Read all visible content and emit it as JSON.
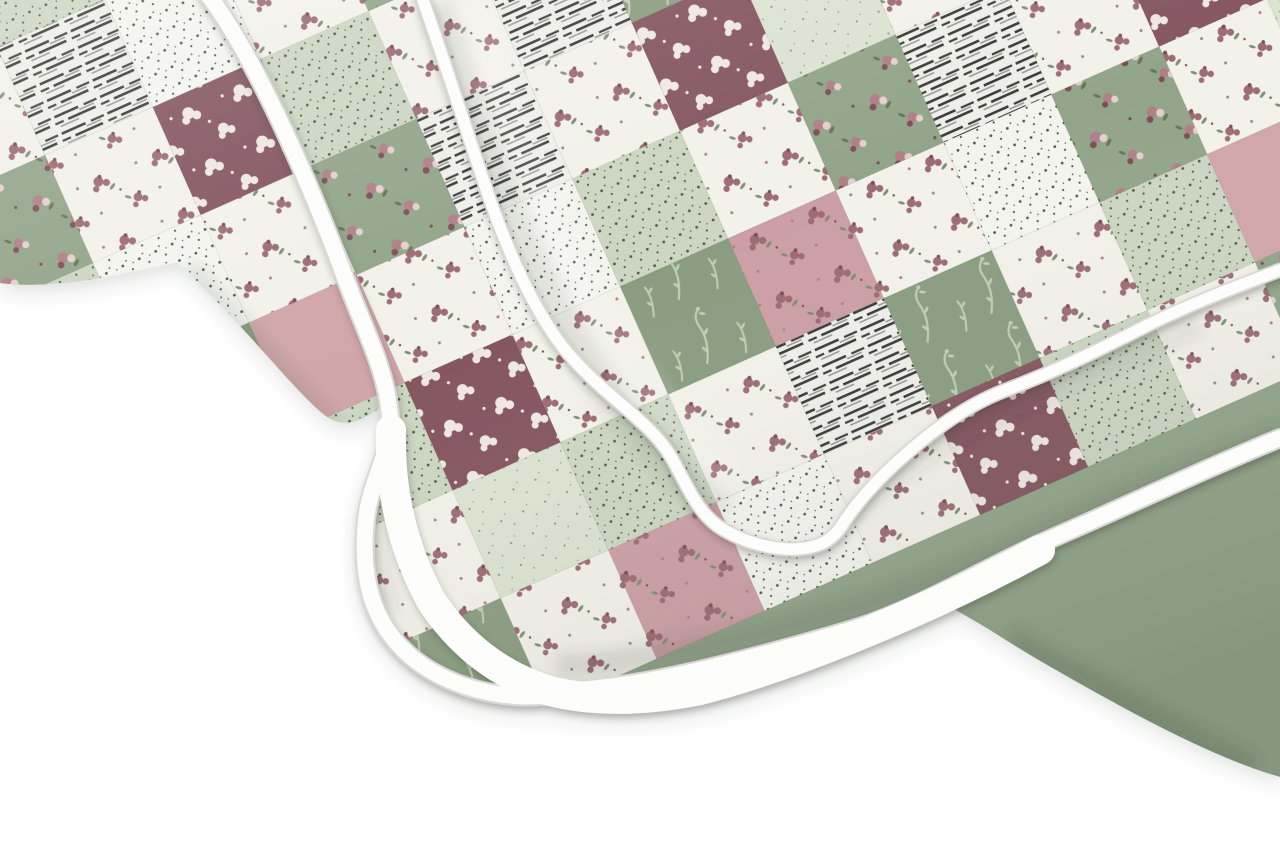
{
  "meta": {
    "description": "Product photo of a folded quilted patchwork bedspread with rounded white piped binding edges, draped diagonally across the top of the frame on a plain white background. The patchwork mixes sage green damask squares, light green and white dotted prints, white patches with dusty-rose flower clusters, wine-red floral squares, solid dusty pink and cream strips, and white patches with thin gray stripes."
  },
  "quilt": {
    "patch_size": 118,
    "patch_rotation_deg": -24,
    "palette": {
      "bg": "#ffffff",
      "sage": "#92a58a",
      "sage2": "#8a9d81",
      "ltgreen": "#ccd6c2",
      "mint": "#dce3d1",
      "cream": "#e8e8d1",
      "pink": "#d1a6a9",
      "pink2": "#cb9fa5",
      "white": "#f2f1ea",
      "white2": "#f4f4ef",
      "white3": "#efefe9",
      "wine": "#855660",
      "dotcol": "#4c5a46",
      "dotcol2": "#8b9b80",
      "rose": "#b07f87",
      "rosedark": "#7e4e57",
      "mauve": "#9d6b74",
      "leaf": "#7e8f76",
      "leafdark": "#647555",
      "blush": "#e5cfcd",
      "whiteblob": "#efe8e2",
      "sprig": "#bfcfb2",
      "stripe": "#3b3b3b",
      "stripe2": "#9a9a98",
      "binding": "#fdfdfc",
      "bindrim": "#d8d8d4",
      "shadow": "#3f463a"
    },
    "patch_types": {
      "gf": {
        "base": "sage",
        "pattern": "floralPink"
      },
      "gd": {
        "base": "sage2",
        "pattern": "sprig"
      },
      "lg": {
        "base": "ltgreen",
        "pattern": "dots"
      },
      "mint": {
        "base": "mint",
        "pattern": "dots2"
      },
      "cream": {
        "base": "cream",
        "pattern": null
      },
      "pink": {
        "base": "pink",
        "pattern": null
      },
      "pf": {
        "base": "pink2",
        "pattern": "floralMauve"
      },
      "wf": {
        "base": "white",
        "pattern": "floralMauve"
      },
      "wine": {
        "base": "wine",
        "pattern": "floralWhite"
      },
      "dot": {
        "base": "white2",
        "pattern": "dots"
      },
      "str": {
        "base": "white3",
        "pattern": "stripes"
      }
    },
    "patch_grid": [
      [
        "gf",
        "wf",
        "str",
        "dot",
        "lg",
        "wf",
        "gd",
        "mint",
        "wf",
        "pink",
        "str",
        "wf",
        "gf",
        "lg"
      ],
      [
        "lg",
        "gf",
        "wf",
        "str",
        "wine",
        "wf",
        "dot",
        "gd",
        "pf",
        "wf",
        "mint",
        "gf",
        "wf",
        "dot"
      ],
      [
        "wf",
        "dot",
        "gf",
        "wf",
        "str",
        "lg",
        "wf",
        "wine",
        "gd",
        "cream",
        "wf",
        "dot",
        "pink",
        "wf"
      ],
      [
        "gd",
        "wf",
        "lg",
        "pf",
        "wf",
        "dot",
        "gf",
        "wf",
        "str",
        "wf",
        "lg",
        "wine",
        "wf",
        "mint"
      ],
      [
        "dot",
        "lg",
        "wf",
        "gd",
        "cream",
        "wf",
        "pink",
        "wf",
        "lg",
        "gf",
        "wf",
        "str",
        "wf",
        "gd"
      ],
      [
        "wf",
        "str",
        "dot",
        "wf",
        "gf",
        "mint",
        "wf",
        "lg",
        "wine",
        "wf",
        "dot",
        "gf",
        "cream",
        "wf"
      ],
      [
        "gf",
        "wf",
        "wine",
        "lg",
        "wf",
        "str",
        "gd",
        "wf",
        "pf",
        "mint",
        "gf",
        "wf",
        "str",
        "lg"
      ],
      [
        "lg",
        "dot",
        "wf",
        "gf",
        "str",
        "wf",
        "wine",
        "mint",
        "wf",
        "gd",
        "wf",
        "pink",
        "wf",
        "gf"
      ],
      [
        "wf",
        "gd",
        "pink",
        "wf",
        "dot",
        "lg",
        "wf",
        "gf",
        "str",
        "wf",
        "wine",
        "lg",
        "gf",
        "wf"
      ],
      [
        "str",
        "wf",
        "lg",
        "wine",
        "wf",
        "gd",
        "pf",
        "wf",
        "dot",
        "gf",
        "wf",
        "mint",
        "wf",
        "dot"
      ],
      [
        "dot",
        "gf",
        "wf",
        "mint",
        "lg",
        "wf",
        "str",
        "gd",
        "wf",
        "lg",
        "pink",
        "wf",
        "gf",
        "str"
      ],
      [
        "wf",
        "lg",
        "gd",
        "wf",
        "pf",
        "dot",
        "wf",
        "wine",
        "lg",
        "wf",
        "gf",
        "dot",
        "wf",
        "lg"
      ]
    ]
  }
}
